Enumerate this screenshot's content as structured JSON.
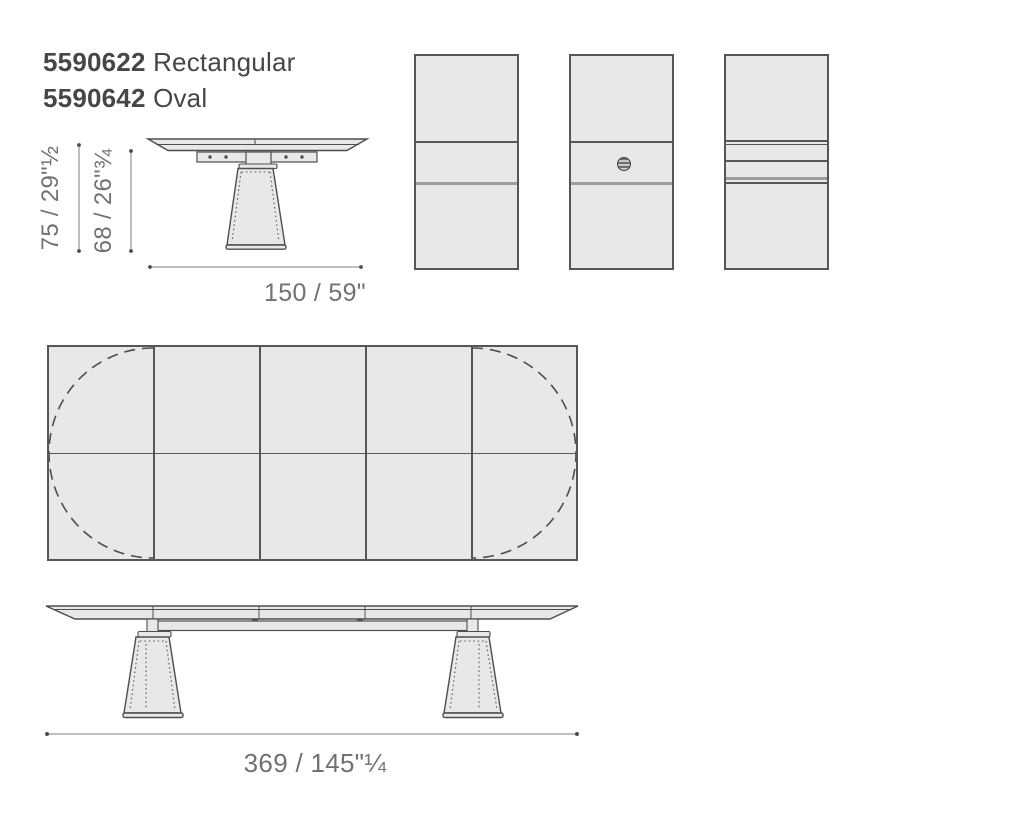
{
  "products": [
    {
      "code": "5590622",
      "name": "Rectangular"
    },
    {
      "code": "5590642",
      "name": "Oval"
    }
  ],
  "dimensions": {
    "overall_height": "75 / 29\"½",
    "clearance_height": "68 / 26\"¾",
    "depth": "150 / 59\"",
    "length": "369 / 145\"¼"
  },
  "colors": {
    "background": "#ffffff",
    "fill": "#e8e8e9",
    "outline": "#4d4e50",
    "thick_line": "#9b9c9e",
    "dim_line": "#7e7f82",
    "dim_text": "#707174",
    "title_text": "#454648"
  }
}
